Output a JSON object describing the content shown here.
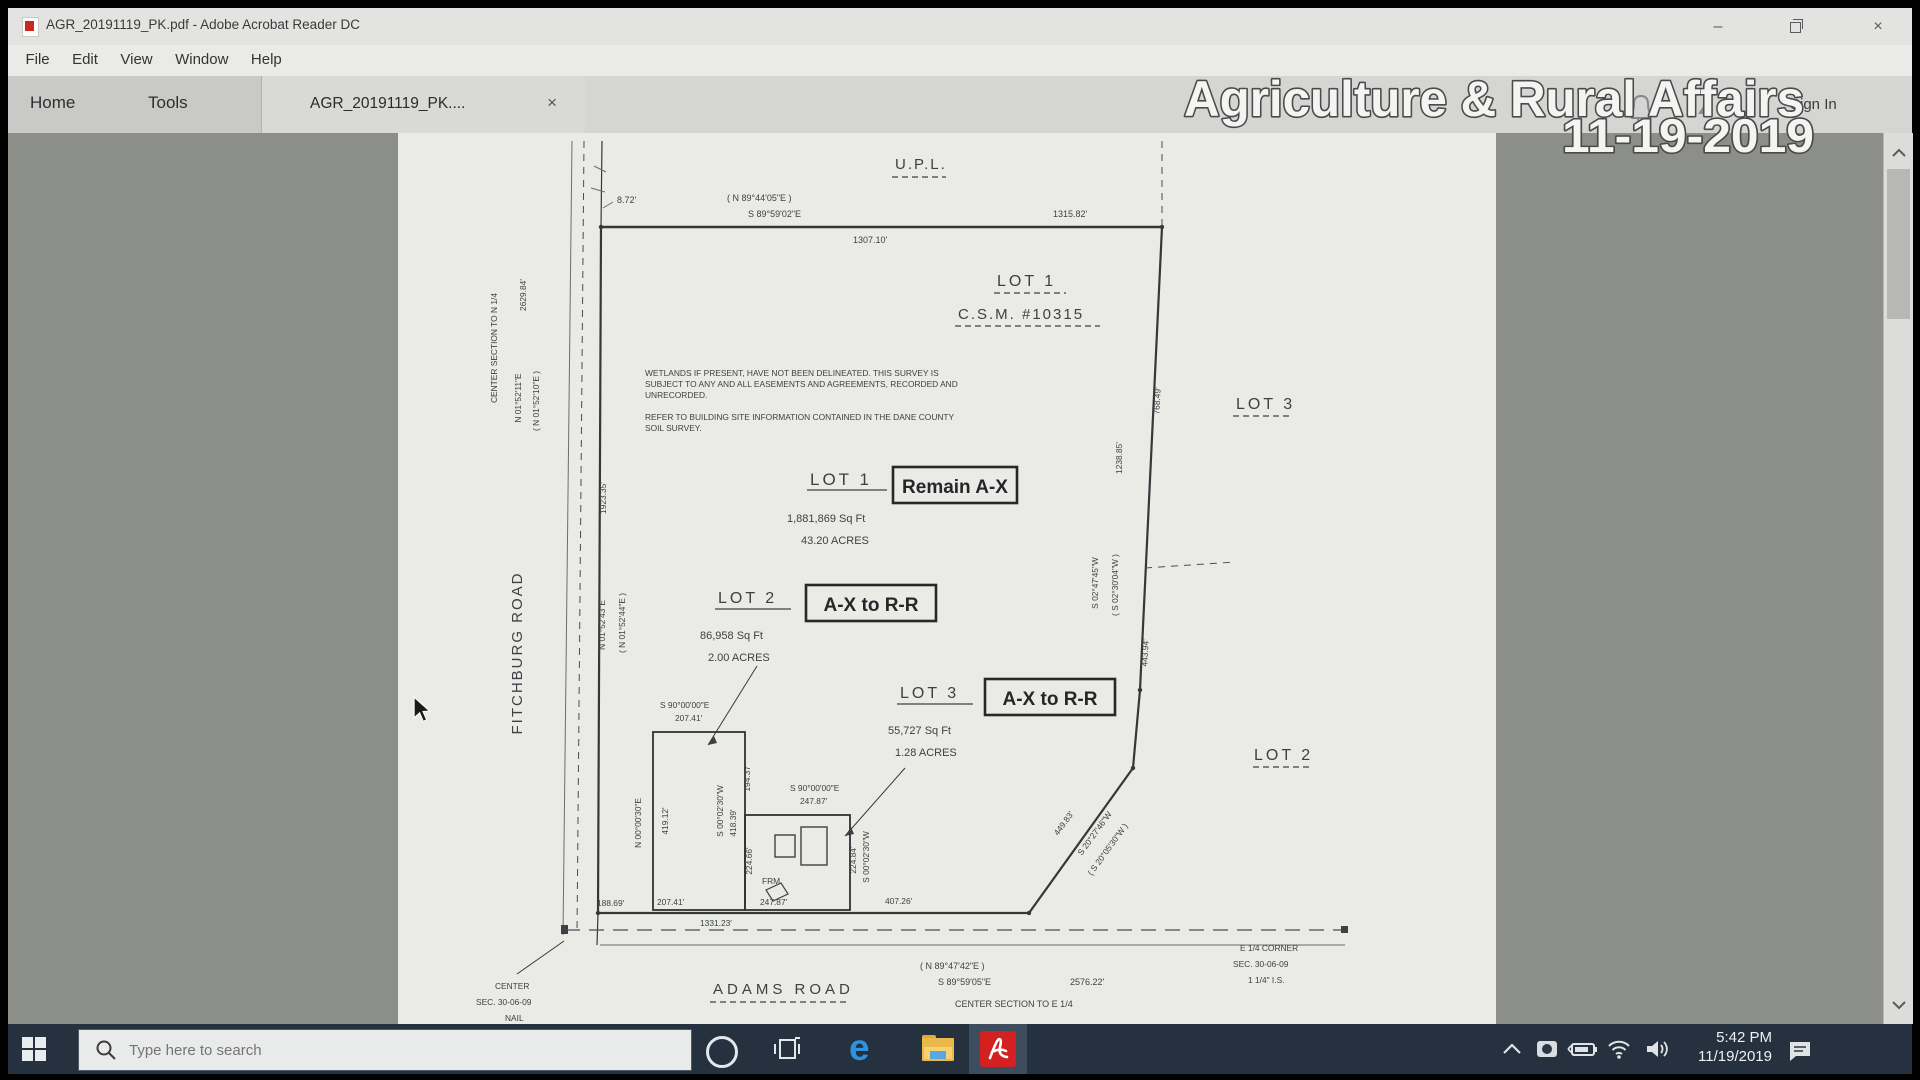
{
  "window": {
    "title": "AGR_20191119_PK.pdf - Adobe Acrobat Reader DC",
    "controls": {
      "minimize": "–",
      "close": "×"
    }
  },
  "menu": {
    "items": [
      "File",
      "Edit",
      "View",
      "Window",
      "Help"
    ]
  },
  "tabs": {
    "home": "Home",
    "tools": "Tools",
    "doc_tab": "AGR_20191119_PK....",
    "close_glyph": "×",
    "sign_in": "Sign In"
  },
  "overlay": {
    "title": "Agriculture & Rural Affairs",
    "date": "11-19-2019"
  },
  "map": {
    "upl": "U.P.L.",
    "top": {
      "bearing_paren": "( N 89°44'05\"E )",
      "bearing": "S 89°59'02\"E",
      "dist_outer": "1315.82'",
      "dist_inner": "1307.10'",
      "offset": "8.72'"
    },
    "csm": {
      "lot": "LOT 1",
      "name": "C.S.M. #10315"
    },
    "adjacent": {
      "lot3": "LOT 3",
      "lot2": "LOT 2"
    },
    "notes": {
      "l1": "WETLANDS IF PRESENT, HAVE NOT BEEN DELINEATED.  THIS SURVEY IS",
      "l2": "SUBJECT TO ANY AND ALL EASEMENTS AND AGREEMENTS, RECORDED AND",
      "l3": "UNRECORDED.",
      "l4": "REFER TO BUILDING SITE INFORMATION CONTAINED IN THE DANE COUNTY",
      "l5": "SOIL SURVEY."
    },
    "lot1": {
      "title": "LOT 1",
      "tag": "Remain A-X",
      "sqft": "1,881,869 Sq Ft",
      "acres": "43.20 ACRES"
    },
    "lot2": {
      "title": "LOT 2",
      "tag": "A-X to R-R",
      "sqft": "86,958 Sq Ft",
      "acres": "2.00 ACRES"
    },
    "lot3": {
      "title": "LOT 3",
      "tag": "A-X to R-R",
      "sqft": "55,727 Sq Ft",
      "acres": "1.28 ACRES"
    },
    "west": {
      "center_section": "CENTER SECTION TO N 1/4",
      "center_dist": "2629.84'",
      "bearing": "N 01°52'11\"E",
      "bearing_paren": "( N 01°52'10\"E )",
      "road": "FITCHBURG ROAD",
      "dist": "1923.35'",
      "bearing2": "N 01°52'43\"E",
      "bearing2_paren": "( N 01°52'44\"E )"
    },
    "east": {
      "dist_outer": "768.49'",
      "dist_inner": "1238.85'",
      "bearing": "S 02°47'45\"W",
      "bearing_paren": "( S 02°30'04\"W )",
      "dist2": "443.94'",
      "diag_dist": "449.83'",
      "diag_bearing": "S 20°27'46\"W",
      "diag_bearing_paren": "( S 20°05'30\"W )"
    },
    "lot2_rect": {
      "top_bearing": "S 90°00'00\"E",
      "top_dist": "207.41'",
      "left_bearing": "N 00°00'30\"E",
      "left_dist": "419.12'",
      "right_bearing": "S 00°02'30\"W",
      "right_dist": "418.39'",
      "seg_dist": "194.37'"
    },
    "lot3_rect": {
      "top_bearing": "S 90°00'00\"E",
      "top_dist": "247.87'",
      "left_dist": "224.66'",
      "right_dist": "224.84'",
      "right_bearing": "S 00°02'30\"W",
      "frm": "FRM"
    },
    "south": {
      "d1": "188.69'",
      "d2": "207.41'",
      "d3": "247.87'",
      "d4": "407.26'",
      "total": "1331.23'",
      "road": "ADAMS ROAD",
      "bearing_paren": "( N 89°47'42\"E )",
      "bearing": "S 89°59'05\"E",
      "center_dist": "2576.22'",
      "center_label": "CENTER SECTION TO E 1/4"
    },
    "sw_corner": {
      "l1": "CENTER",
      "l2": "SEC. 30-06-09",
      "l3": "NAIL"
    },
    "se_corner": {
      "l1": "E 1/4 CORNER",
      "l2": "SEC. 30-06-09",
      "l3": "1 1/4\" I.S."
    }
  },
  "taskbar": {
    "search_placeholder": "Type here to search",
    "clock_time": "5:42 PM",
    "clock_date": "11/19/2019"
  }
}
